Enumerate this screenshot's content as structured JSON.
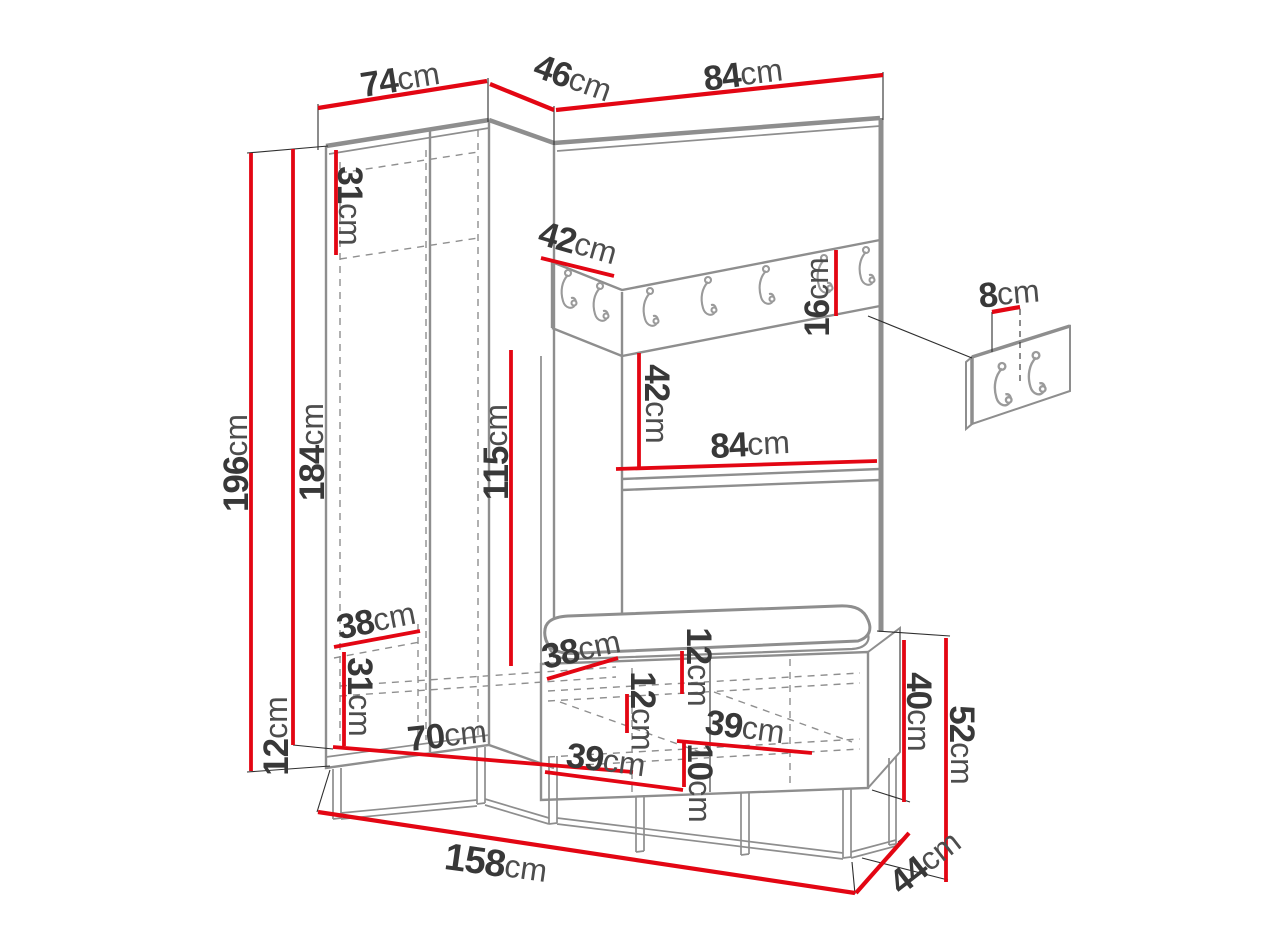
{
  "diagram": {
    "subject": "hallway wardrobe set dimension drawing with hook rail, shoe bench and wall hook panel detail",
    "unit": "cm",
    "colors": {
      "dimension_line": "#e30613",
      "furniture_line": "#8e8e8e",
      "label_text": "#383838"
    },
    "hook_counts": {
      "rail_left_section": 2,
      "rail_right_section": 5,
      "detail_panel": 2
    },
    "dimensions": {
      "top_width_left": "74",
      "top_depth_corner": "46",
      "top_width_right": "84",
      "height_total": "196",
      "height_body": "184",
      "height_legs": "12",
      "top_shelf_height": "31",
      "shelf_depth": "42",
      "hook_rail_height": "16",
      "niche_height": "42",
      "niche_width": "84",
      "hanging_height": "115",
      "bottom_shelf_depth": "38",
      "bottom_compartment_height": "31",
      "interior_width": "70",
      "bench_depth": "38",
      "bench_top_inset": "12",
      "bench_shelf_inset": "12",
      "bench_compartment_width_top": "39",
      "bench_compartment_width_bottom": "39",
      "bench_bottom_inset": "10",
      "bench_body_height": "40",
      "bench_height_total": "52",
      "width_total": "158",
      "depth_total": "44",
      "hook_panel_spacing": "8"
    }
  }
}
